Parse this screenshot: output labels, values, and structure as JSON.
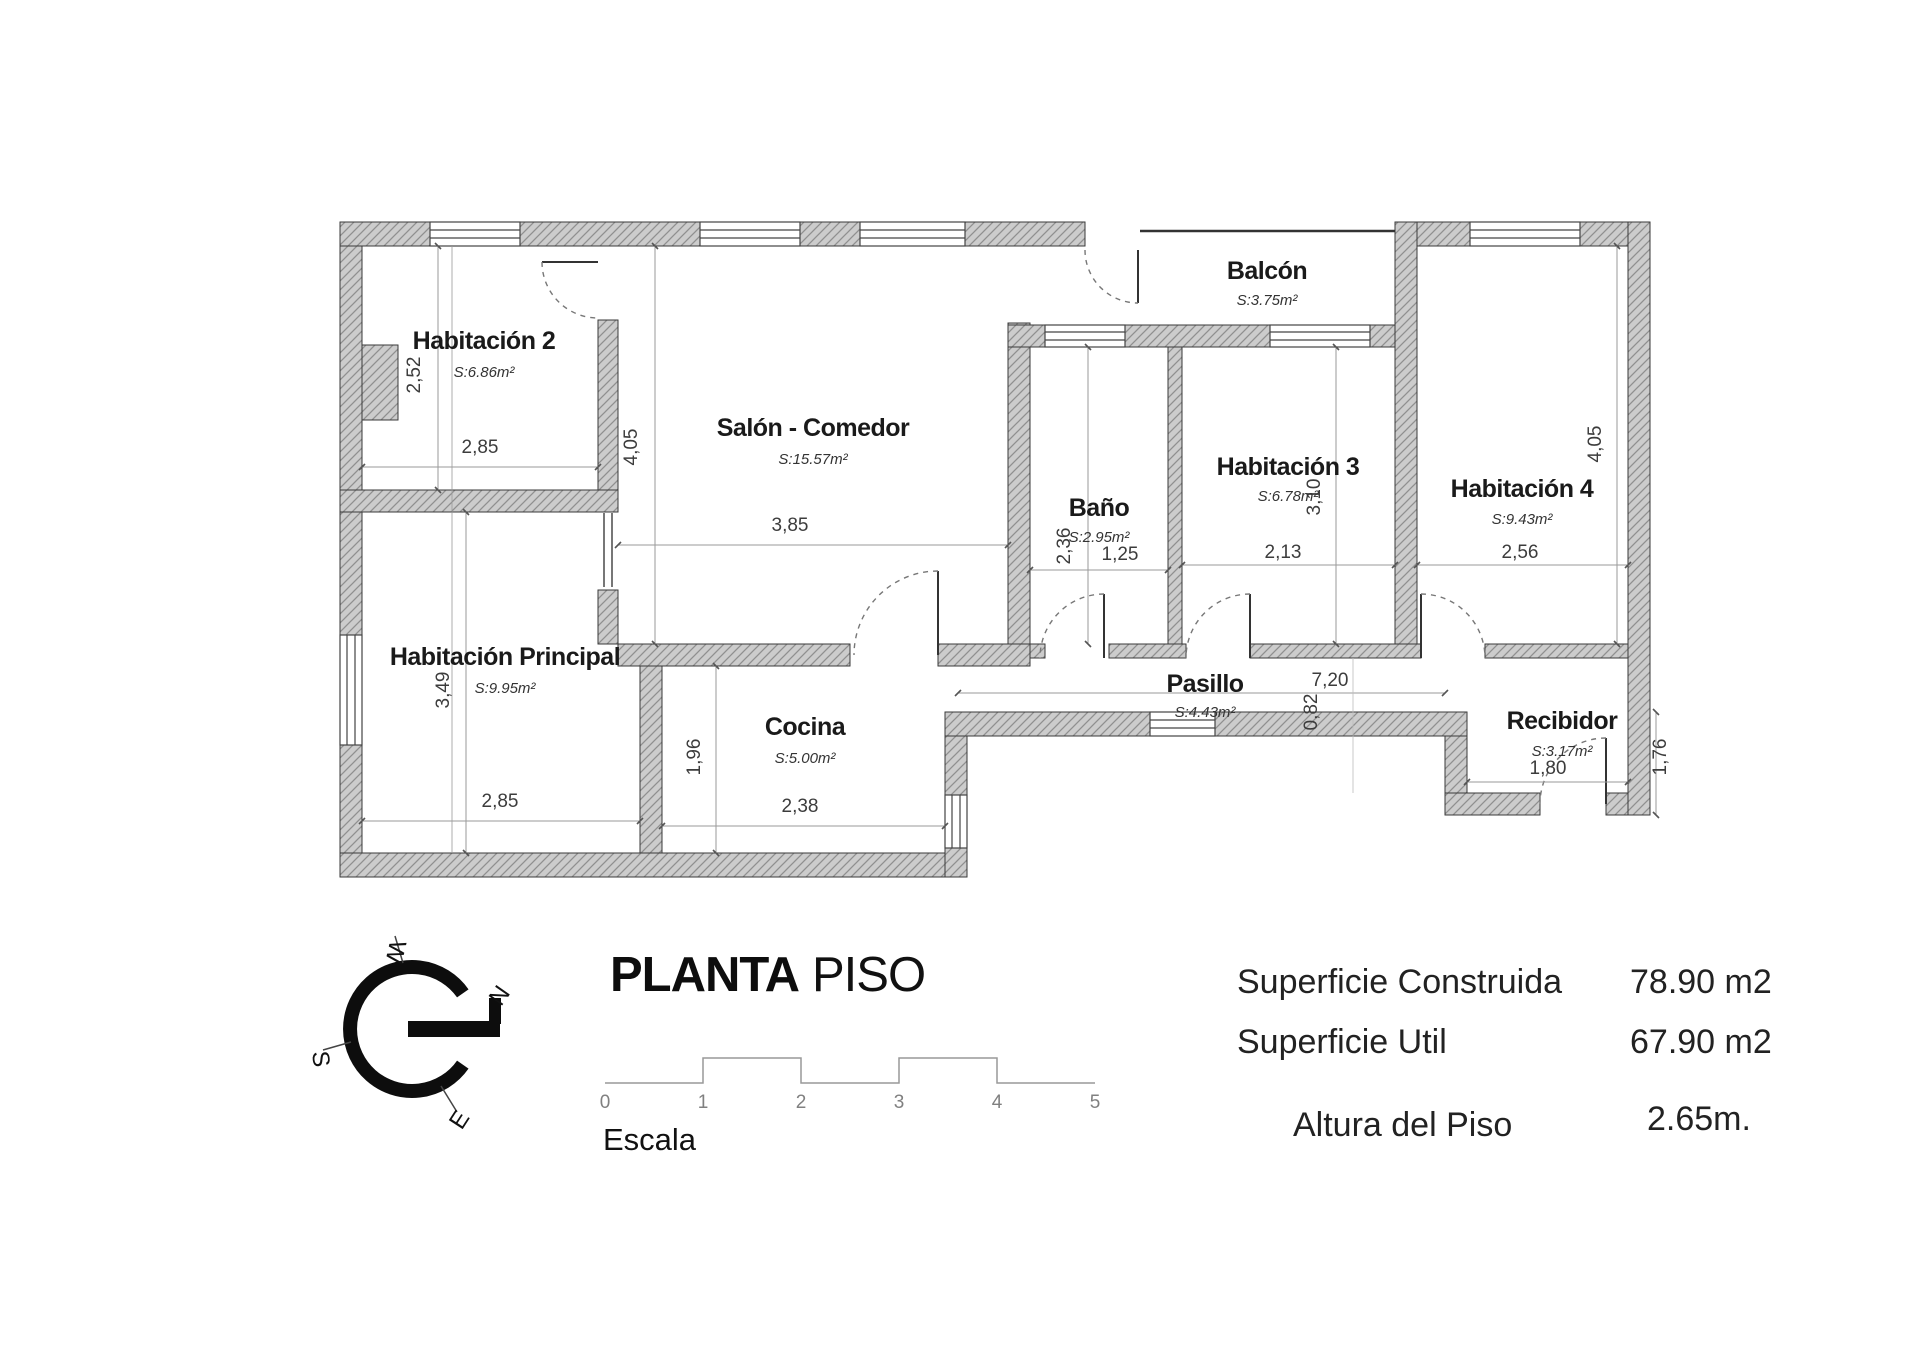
{
  "title": {
    "bold": "PLANTA",
    "regular": "PISO"
  },
  "rooms": {
    "hab2": {
      "name": "Habitación 2",
      "area": "S:6.86m²"
    },
    "salon": {
      "name": "Salón - Comedor",
      "area": "S:15.57m²"
    },
    "balcon": {
      "name": "Balcón",
      "area": "S:3.75m²"
    },
    "bano": {
      "name": "Baño",
      "area": "S:2.95m²"
    },
    "hab3": {
      "name": "Habitación 3",
      "area": "S:6.78m²"
    },
    "hab4": {
      "name": "Habitación 4",
      "area": "S:9.43m²"
    },
    "principal": {
      "name": "Habitación Principal",
      "area": "S:9.95m²"
    },
    "cocina": {
      "name": "Cocina",
      "area": "S:5.00m²"
    },
    "pasillo": {
      "name": "Pasillo",
      "area": "S:4.43m²"
    },
    "recibidor": {
      "name": "Recibidor",
      "area": "S:3.17m²"
    }
  },
  "dims": {
    "hab2_w": "2,85",
    "hab2_h": "2,52",
    "salon_w": "3,85",
    "salon_h": "4,05",
    "principal_w": "2,85",
    "principal_h": "3,49",
    "cocina_w": "2,38",
    "cocina_h": "1,96",
    "bano_w": "1,25",
    "bano_h": "2,36",
    "hab3_w": "2,13",
    "hab3_h": "3,10",
    "hab4_w": "2,56",
    "hab4_h": "4,05",
    "pasillo_w": "7,20",
    "pasillo_h": "0,82",
    "recibidor_w": "1,80",
    "recibidor_h": "1,76"
  },
  "compass": {
    "n": "N",
    "s": "S",
    "e": "E",
    "w": "W"
  },
  "scale": {
    "label": "Escala",
    "marks": [
      "0",
      "1",
      "2",
      "3",
      "4",
      "5"
    ]
  },
  "stats": {
    "construida_label": "Superficie Construida",
    "construida_value": "78.90 m2",
    "util_label": "Superficie Util",
    "util_value": "67.90 m2",
    "altura_label": "Altura del Piso",
    "altura_value": "2.65m."
  }
}
